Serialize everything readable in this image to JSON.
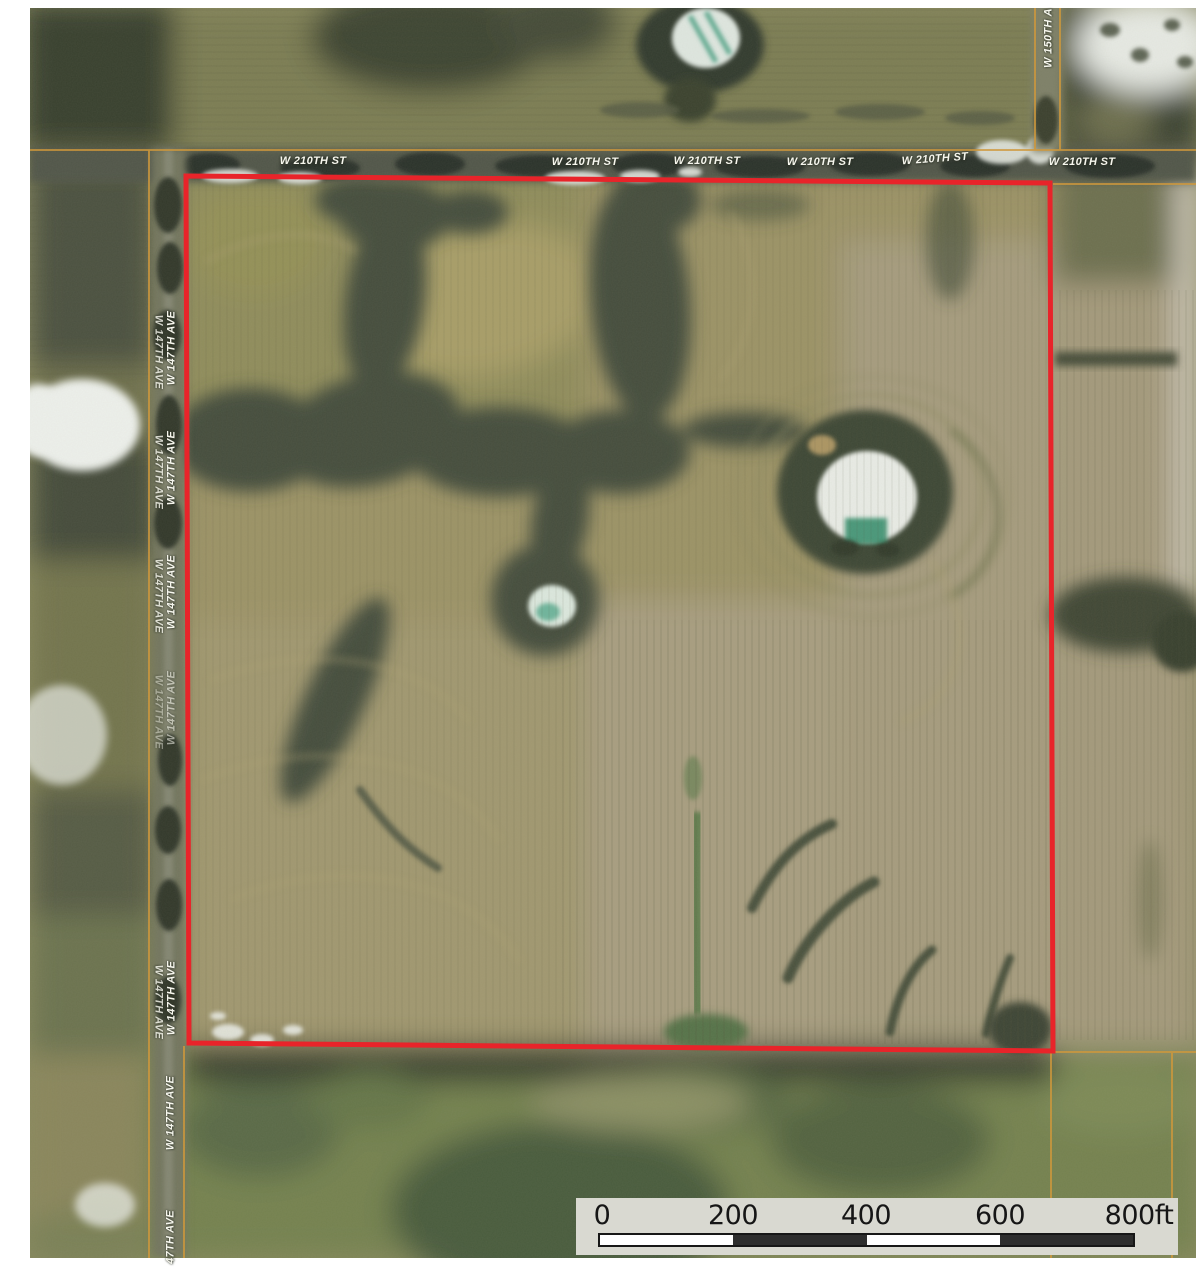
{
  "roads": {
    "top_labels": [
      "W 210TH ST",
      "W 210TH ST",
      "W 210TH ST",
      "W 210TH ST",
      "W 210TH ST",
      "W 210TH ST"
    ],
    "left_labels": [
      "W 147TH AVE",
      "W 147TH AVE",
      "W 147TH AVE",
      "W 147TH AVE",
      "W 147TH AVE",
      "W 147TH AVE",
      "47TH AVE"
    ],
    "right_label": "W 150TH A"
  },
  "parcel": {
    "outline_color": "#e8242a"
  },
  "lines": {
    "section_line_color": "#cf983c"
  },
  "scale_bar": {
    "tick_labels": [
      "0",
      "200",
      "400",
      "600"
    ],
    "end_label": "800ft",
    "panel_color": "#d9d9d1",
    "bar_light": "#ffffff",
    "bar_dark": "#2e2e2e"
  }
}
